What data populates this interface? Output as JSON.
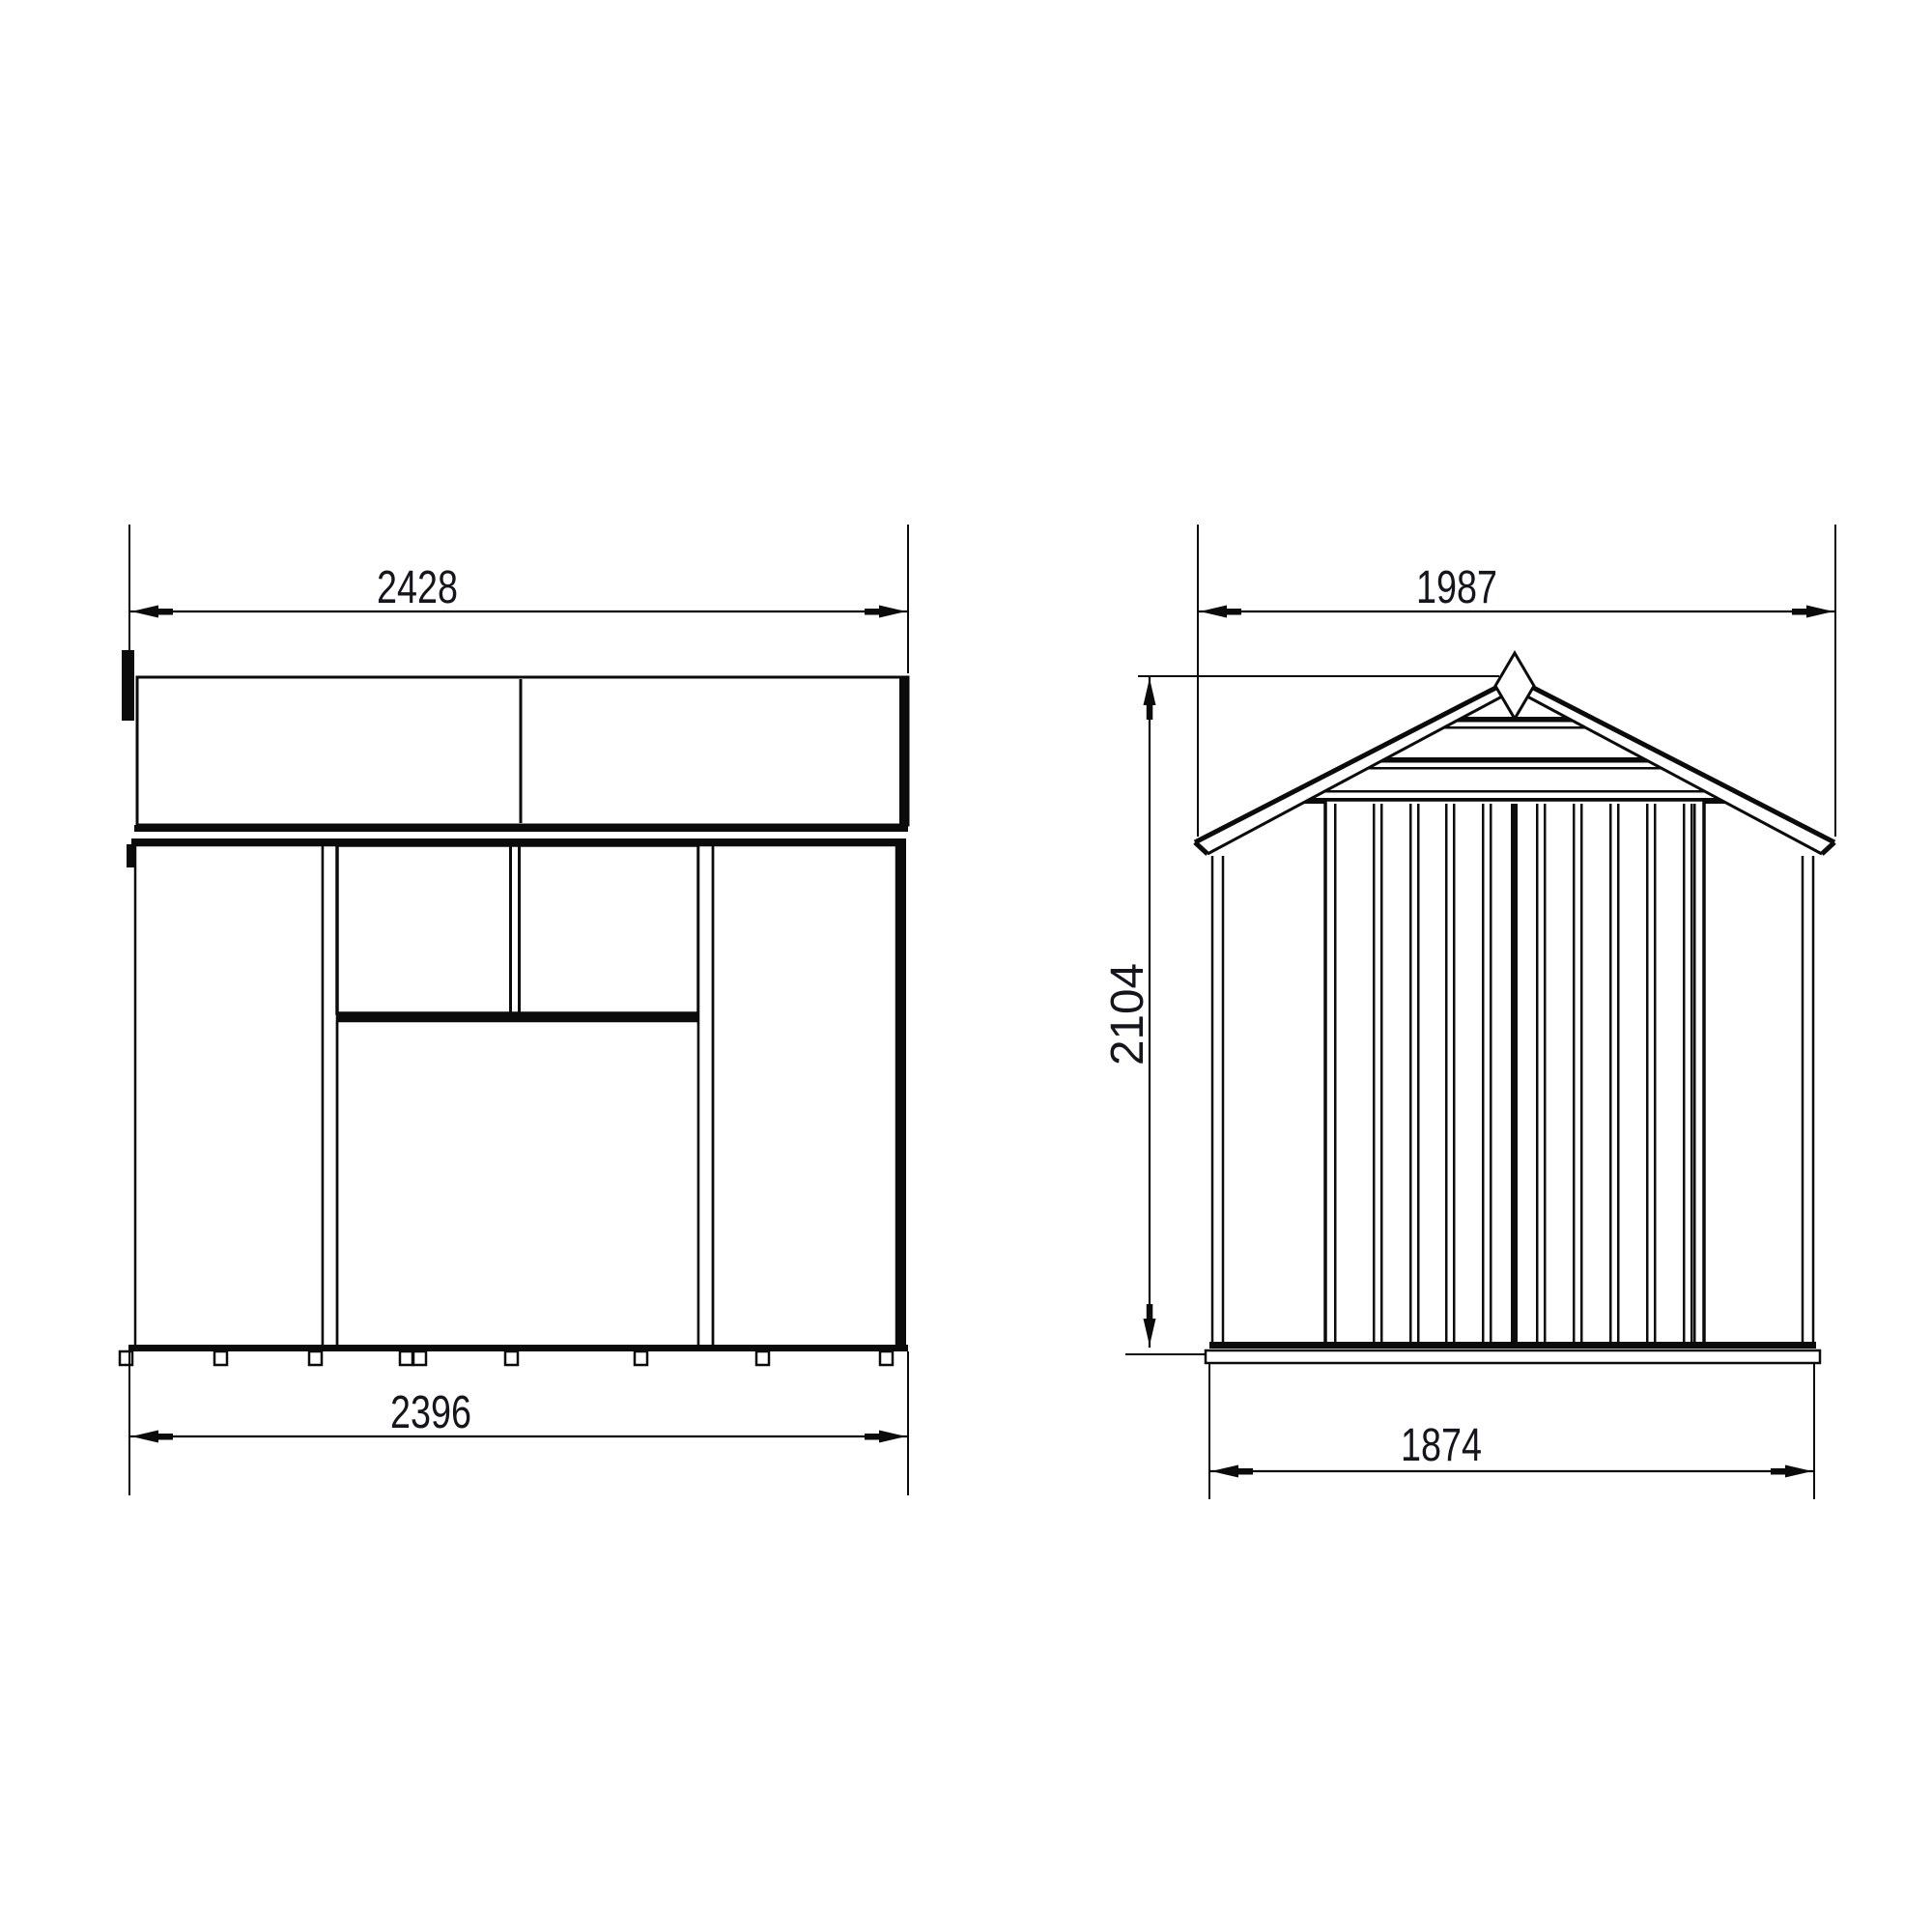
{
  "title": "Shed technical drawing, two elevations with dimensions",
  "colors": {
    "line": "#0b0b0b",
    "background": "#ffffff",
    "text": "#15151d"
  },
  "drawing": {
    "side_view": {
      "name": "side elevation",
      "top_dimension": "2428",
      "bottom_dimension": "2396"
    },
    "front_view": {
      "name": "front gable elevation",
      "top_dimension": "1987",
      "height_dimension": "2104",
      "bottom_dimension": "1874"
    }
  }
}
